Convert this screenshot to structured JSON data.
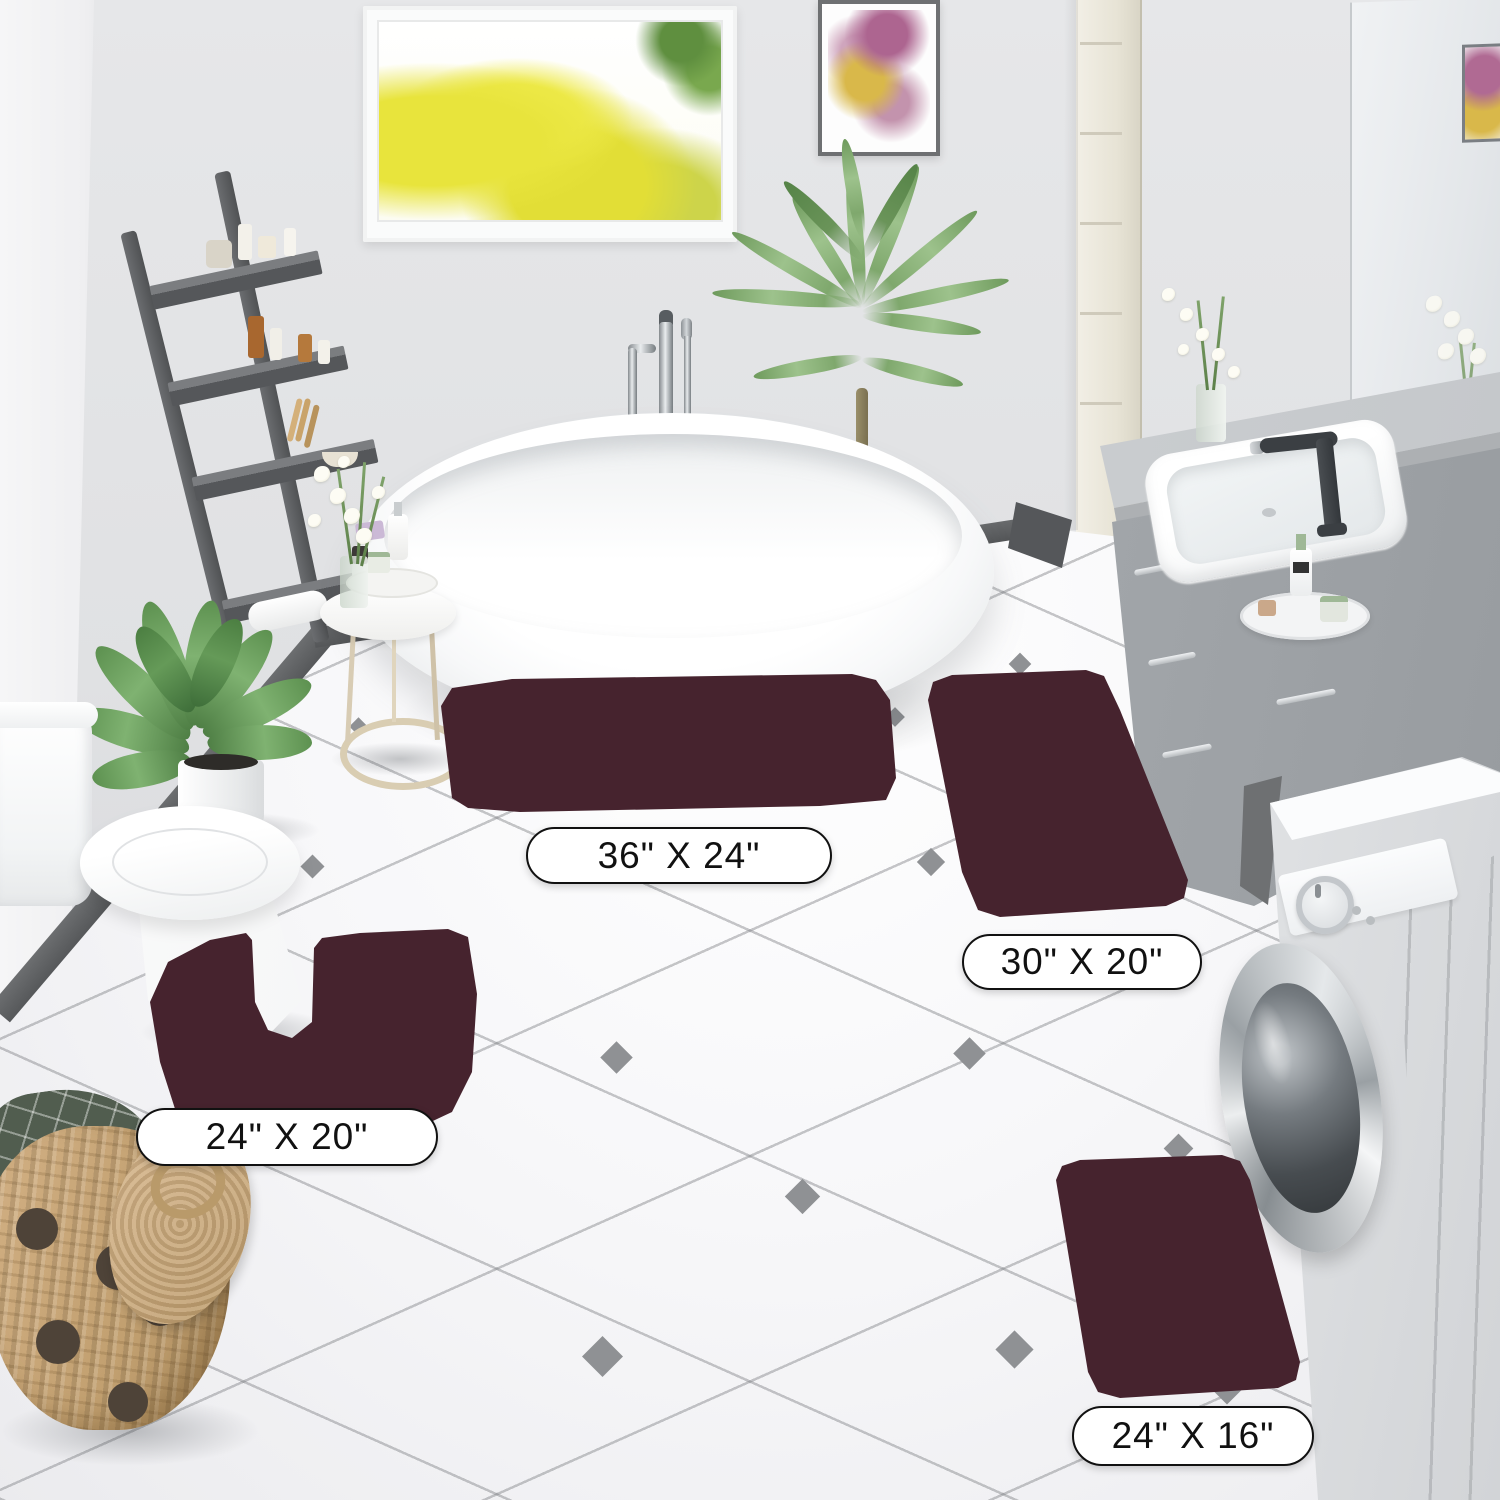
{
  "scene": {
    "description": "Bathroom product photo showing four burgundy chenille bath mats with size callouts",
    "colors": {
      "mat": "#46232e",
      "label_bg": "#ffffff",
      "label_border": "#111111",
      "label_text": "#111111",
      "floor": "#f6f6f8",
      "wall": "#e1e2e4",
      "vanity": "#a9adb1"
    },
    "labels": [
      {
        "id": "mat-36x24",
        "text": "36\" X 24\""
      },
      {
        "id": "mat-30x20",
        "text": "30\" X 20\""
      },
      {
        "id": "mat-24x20",
        "text": "24\" X 20\""
      },
      {
        "id": "mat-24x16",
        "text": "24\" X 16\""
      }
    ]
  }
}
